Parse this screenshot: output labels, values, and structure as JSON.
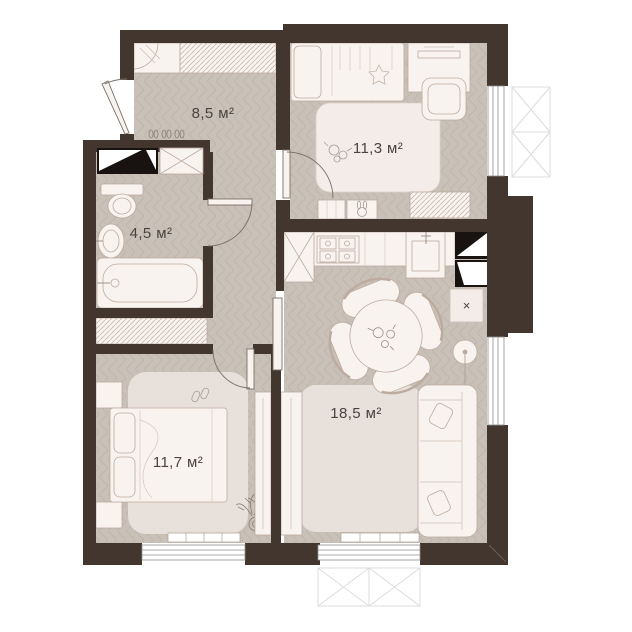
{
  "floor_plan": {
    "rooms": [
      {
        "id": "hallway",
        "area_label": "8,5 м²"
      },
      {
        "id": "children-room",
        "area_label": "11,3 м²"
      },
      {
        "id": "bathroom",
        "area_label": "4,5 м²"
      },
      {
        "id": "bedroom",
        "area_label": "11,7 м²"
      },
      {
        "id": "kitchen-living-room",
        "area_label": "18,5 м²"
      }
    ],
    "symbols": {
      "ventilation_cross": "×"
    },
    "colors": {
      "wall": "#42362e",
      "floor": "#c9c0b7",
      "floor_pattern_line": "#bcb2a8",
      "furniture_fill": "#f9f3ef",
      "furniture_stroke": "#bdab9f",
      "rug": "#e8e0da",
      "children_rug": "#f3ece8",
      "shaft_black": "#181310",
      "window_stroke": "#8f8f8f",
      "balcony_line": "#dcdcdc",
      "label_text": "#4a4340"
    }
  }
}
